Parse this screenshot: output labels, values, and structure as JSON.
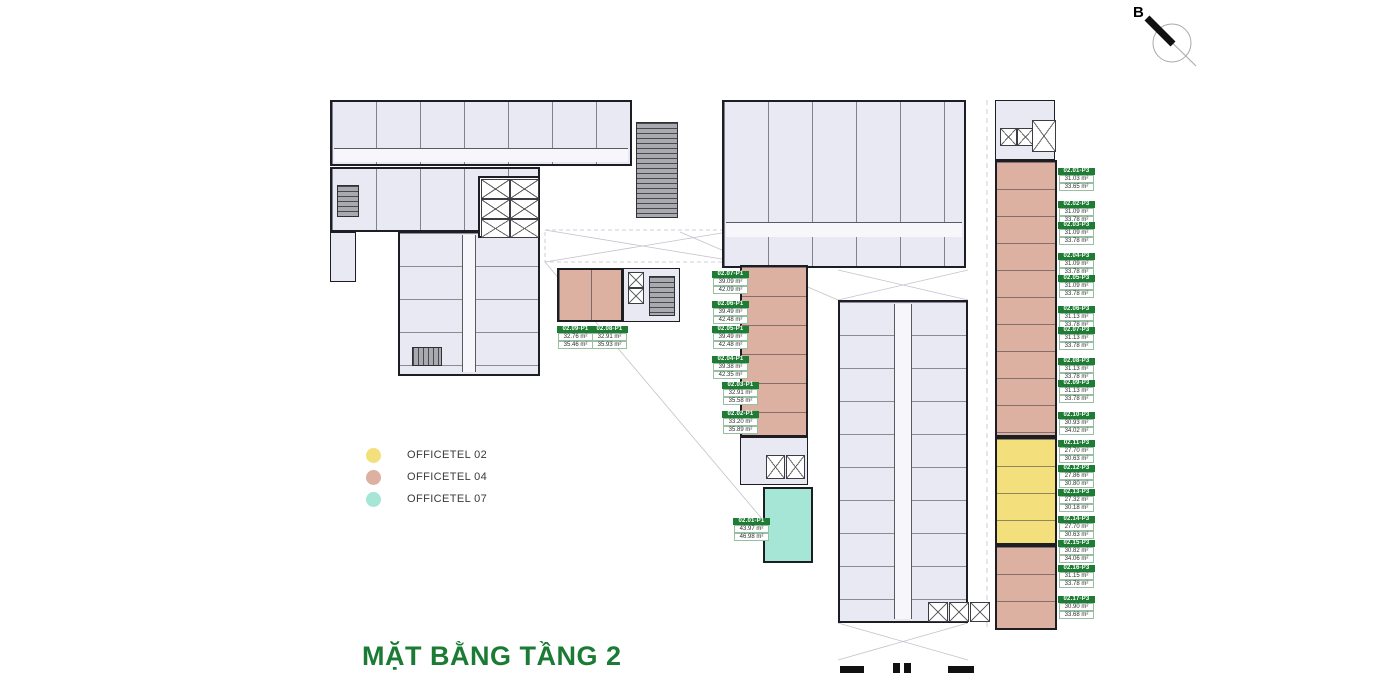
{
  "title": "MẶT BẰNG TẦNG 2",
  "compass": {
    "label": "B"
  },
  "legend": {
    "items": [
      {
        "label": "OFFICETEL 02",
        "color": "#f4df7d"
      },
      {
        "label": "OFFICETEL 04",
        "color": "#dcb1a1"
      },
      {
        "label": "OFFICETEL 07",
        "color": "#a5e6d7"
      }
    ]
  },
  "colors": {
    "officetel02": "#f4df7d",
    "officetel04": "#dcb1a1",
    "officetel07": "#a5e6d7",
    "plan_fill": "#e9e9f4",
    "label_green": "#1e7c35",
    "title_green": "#1b7b34"
  },
  "units": {
    "p3_column": [
      {
        "id": "02.01-P3",
        "areas": [
          "31.03 m²",
          "33.65 m²"
        ]
      },
      {
        "id": "02.02-P3",
        "areas": [
          "31.09 m²",
          "33.78 m²"
        ]
      },
      {
        "id": "02.03-P3",
        "areas": [
          "31.09 m²",
          "33.78 m²"
        ]
      },
      {
        "id": "02.04-P3",
        "areas": [
          "31.09 m²",
          "33.78 m²"
        ]
      },
      {
        "id": "02.05-P3",
        "areas": [
          "31.09 m²",
          "33.78 m²"
        ]
      },
      {
        "id": "02.06-P3",
        "areas": [
          "31.13 m²",
          "33.78 m²"
        ]
      },
      {
        "id": "02.07-P3",
        "areas": [
          "31.13 m²",
          "33.78 m²"
        ]
      },
      {
        "id": "02.08-P3",
        "areas": [
          "31.13 m²",
          "33.78 m²"
        ]
      },
      {
        "id": "02.09-P3",
        "areas": [
          "31.13 m²",
          "33.78 m²"
        ]
      },
      {
        "id": "02.10-P3",
        "areas": [
          "30.93 m²",
          "34.02 m²"
        ]
      },
      {
        "id": "02.11-P3",
        "areas": [
          "27.70 m²",
          "30.63 m²"
        ]
      },
      {
        "id": "02.12-P3",
        "areas": [
          "27.86 m²",
          "30.80 m²"
        ]
      },
      {
        "id": "02.13-P3",
        "areas": [
          "27.32 m²",
          "30.18 m²"
        ]
      },
      {
        "id": "02.14-P3",
        "areas": [
          "27.70 m²",
          "30.63 m²"
        ]
      },
      {
        "id": "02.15-P3",
        "areas": [
          "30.82 m²",
          "34.06 m²"
        ]
      },
      {
        "id": "02.16-P3",
        "areas": [
          "31.15 m²",
          "33.78 m²"
        ]
      },
      {
        "id": "02.17-P3",
        "areas": [
          "30.90 m²",
          "33.68 m²"
        ]
      }
    ],
    "p1_column": [
      {
        "id": "02.07-P1",
        "areas": [
          "39.09 m²",
          "42.09 m²"
        ]
      },
      {
        "id": "02.06-P1",
        "areas": [
          "39.49 m²",
          "42.48 m²"
        ]
      },
      {
        "id": "02.05-P1",
        "areas": [
          "39.49 m²",
          "42.48 m²"
        ]
      },
      {
        "id": "02.04-P1",
        "areas": [
          "39.38 m²",
          "42.35 m²"
        ]
      },
      {
        "id": "02.03-P1",
        "areas": [
          "32.91 m²",
          "35.58 m²"
        ]
      },
      {
        "id": "02.02-P1",
        "areas": [
          "33.20 m²",
          "35.89 m²"
        ]
      }
    ],
    "p1_left_pair": [
      {
        "id": "02.09-P1",
        "areas": [
          "32.76 m²",
          "35.46 m²"
        ]
      },
      {
        "id": "02.08-P1",
        "areas": [
          "32.91 m²",
          "35.93 m²"
        ]
      }
    ],
    "p1_teal": [
      {
        "id": "02.01-P1",
        "areas": [
          "43.97 m²",
          "46.98 m²"
        ]
      }
    ]
  }
}
